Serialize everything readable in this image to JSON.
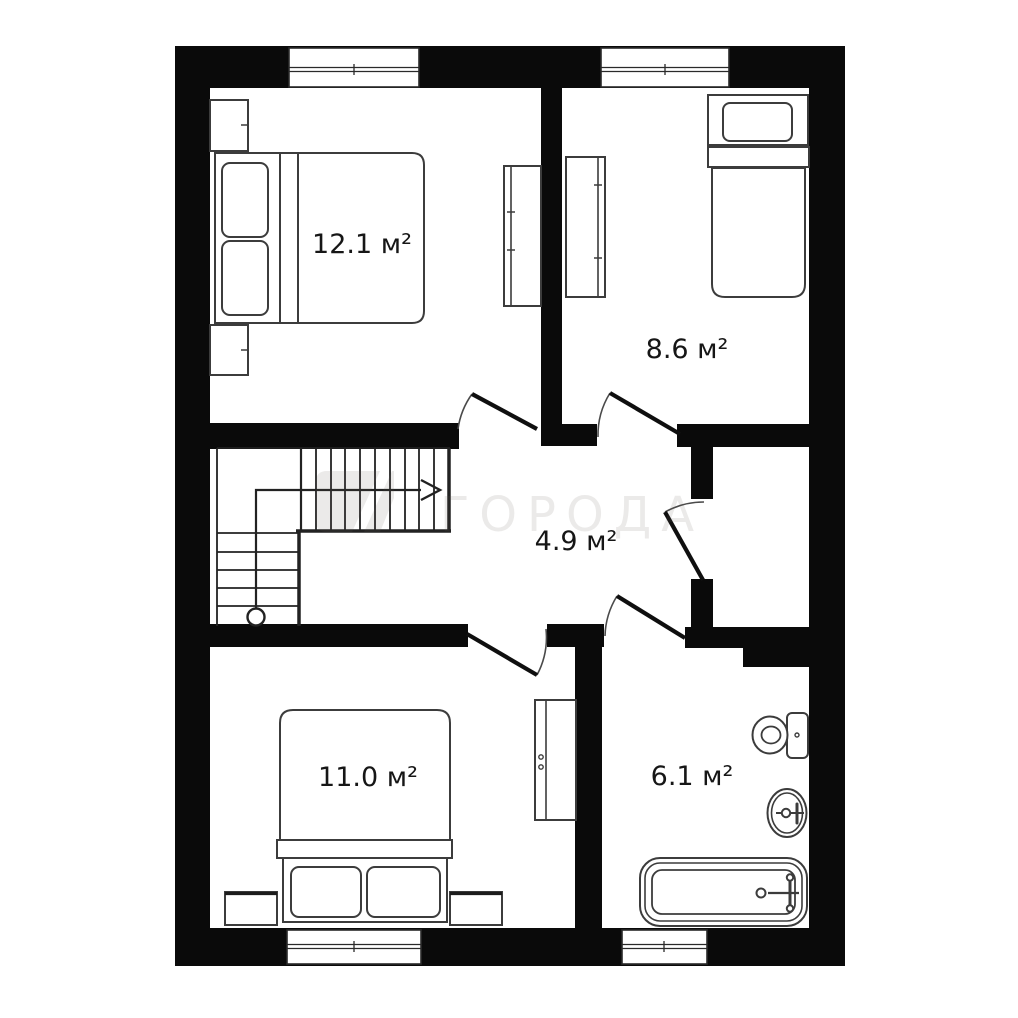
{
  "watermark": {
    "text": "ГОРОДА"
  },
  "rooms": [
    {
      "id": "bedroom-top-left",
      "area_label": "12.1 м²"
    },
    {
      "id": "bedroom-top-right",
      "area_label": "8.6 м²"
    },
    {
      "id": "hallway",
      "area_label": "4.9 м²"
    },
    {
      "id": "bedroom-bottom-left",
      "area_label": "11.0 м²"
    },
    {
      "id": "bathroom",
      "area_label": "6.1 м²"
    }
  ],
  "colors": {
    "wall": "#0a0a0a",
    "furniture_line": "#3c3c3c",
    "watermark_fill": "rgba(104,95,84,0.13)"
  }
}
